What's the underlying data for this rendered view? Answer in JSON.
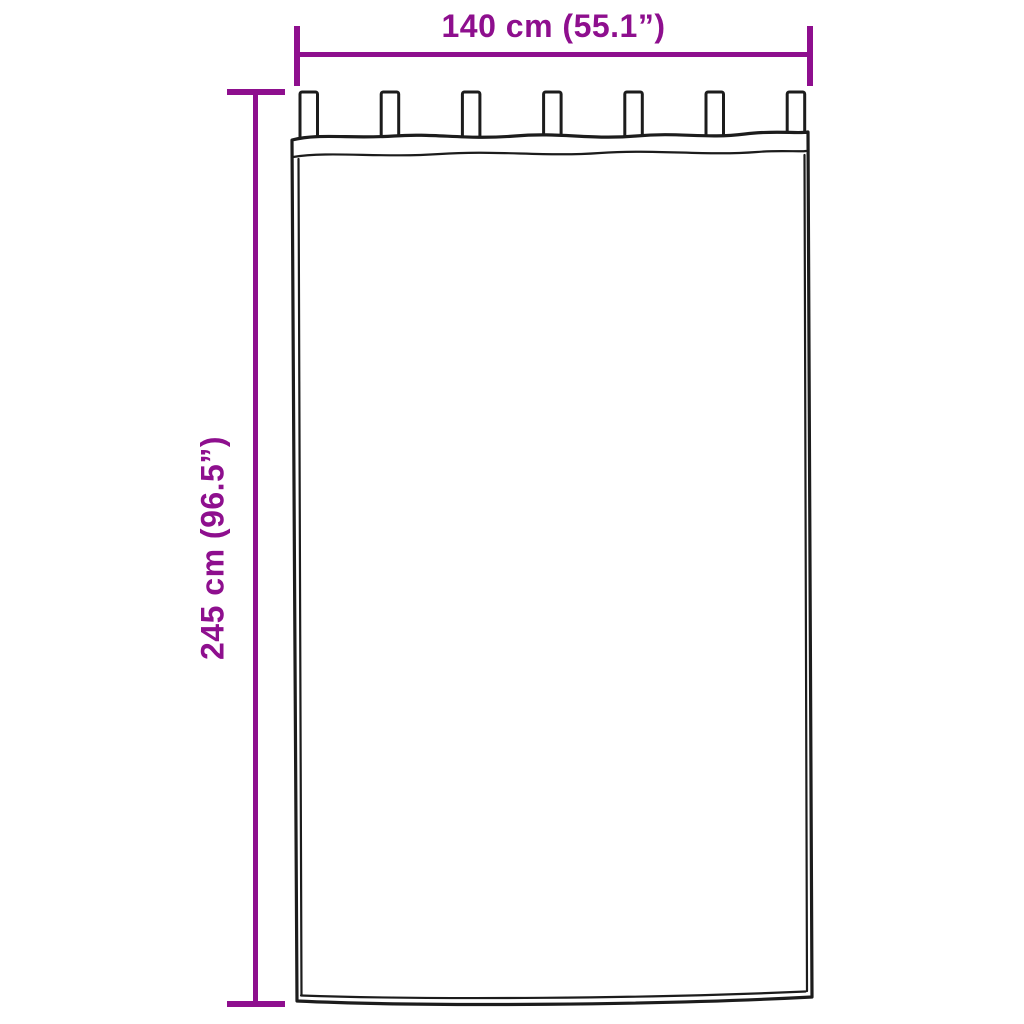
{
  "diagram": {
    "type": "product-dimension-diagram",
    "subject": "tab-top-curtain",
    "width_label": "140 cm (55.1”)",
    "height_label": "245 cm (96.5”)",
    "tab_count": 7,
    "colors": {
      "accent": "#8E0F8E",
      "outline": "#1C1C1C",
      "background": "#FFFFFF"
    }
  }
}
